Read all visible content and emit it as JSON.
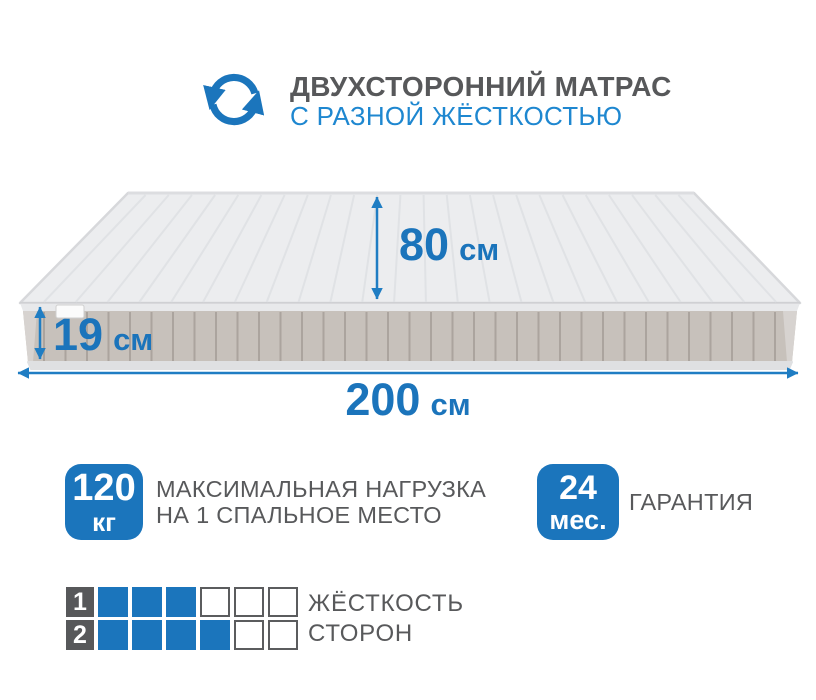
{
  "colors": {
    "primary_blue": "#1b75bc",
    "subtitle_blue": "#1e87d0",
    "text_gray": "#57585a",
    "mattress_top": "#ebecee",
    "mattress_side": "#c7c1bb"
  },
  "header": {
    "icon": "rotate-arrows-icon",
    "title": "ДВУХСТОРОННИЙ МАТРАС",
    "subtitle": "С РАЗНОЙ ЖЁСТКОСТЬЮ"
  },
  "dimensions": {
    "width": {
      "value": "80",
      "unit": "см"
    },
    "thickness": {
      "value": "19",
      "unit": "см"
    },
    "length": {
      "value": "200",
      "unit": "см"
    }
  },
  "badges": [
    {
      "value": "120",
      "unit": "кг",
      "caption_line1": "МАКСИМАЛЬНАЯ НАГРУЗКА",
      "caption_line2": "НА 1 СПАЛЬНОЕ МЕСТО"
    },
    {
      "value": "24",
      "unit": "мес.",
      "caption_line1": "ГАРАНТИЯ",
      "caption_line2": ""
    }
  ],
  "firmness": {
    "label_line1": "ЖЁСТКОСТЬ",
    "label_line2": "СТОРОН",
    "scale_max": 6,
    "sides": [
      {
        "side": "1",
        "filled": 3
      },
      {
        "side": "2",
        "filled": 4
      }
    ]
  }
}
